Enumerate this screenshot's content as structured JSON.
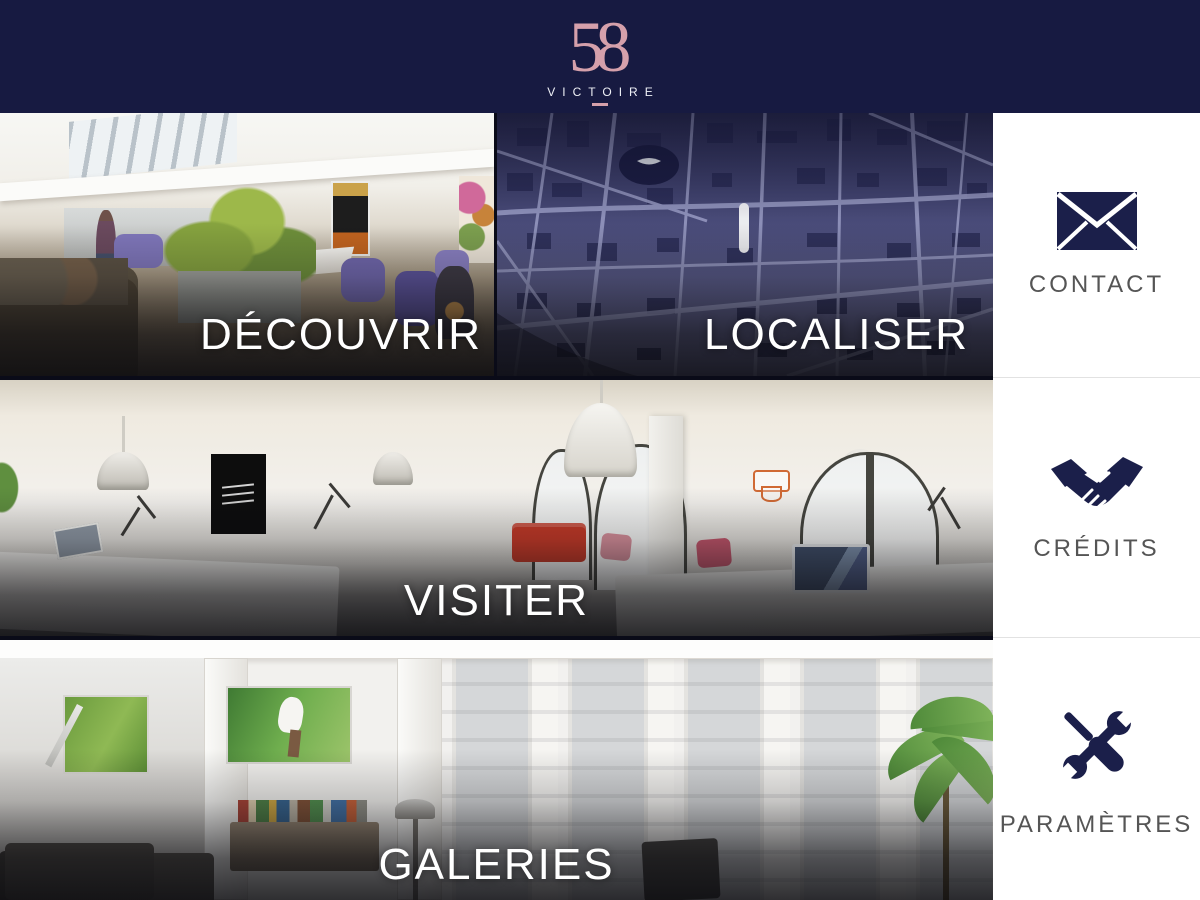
{
  "header": {
    "logo_number": "58",
    "logo_name": "VICTOIRE"
  },
  "tiles": [
    {
      "id": "decouvrir",
      "label": "DÉCOUVRIR"
    },
    {
      "id": "localiser",
      "label": "LOCALISER"
    },
    {
      "id": "visiter",
      "label": "VISITER"
    },
    {
      "id": "galeries",
      "label": "GALERIES"
    }
  ],
  "sidebar": {
    "items": [
      {
        "icon": "envelope-icon",
        "label": "CONTACT"
      },
      {
        "icon": "handshake-icon",
        "label": "CRÉDITS"
      },
      {
        "icon": "tools-icon",
        "label": "PARAMÈTRES"
      }
    ]
  },
  "colors": {
    "header_bg": "#171a41",
    "logo_pink": "#d5a0ab",
    "icon_navy": "#1b1f4a",
    "sidebar_bg": "#ffffff",
    "sidebar_label": "#555555",
    "tile_label": "#ffffff",
    "map_bg": "#4b4d7b"
  }
}
